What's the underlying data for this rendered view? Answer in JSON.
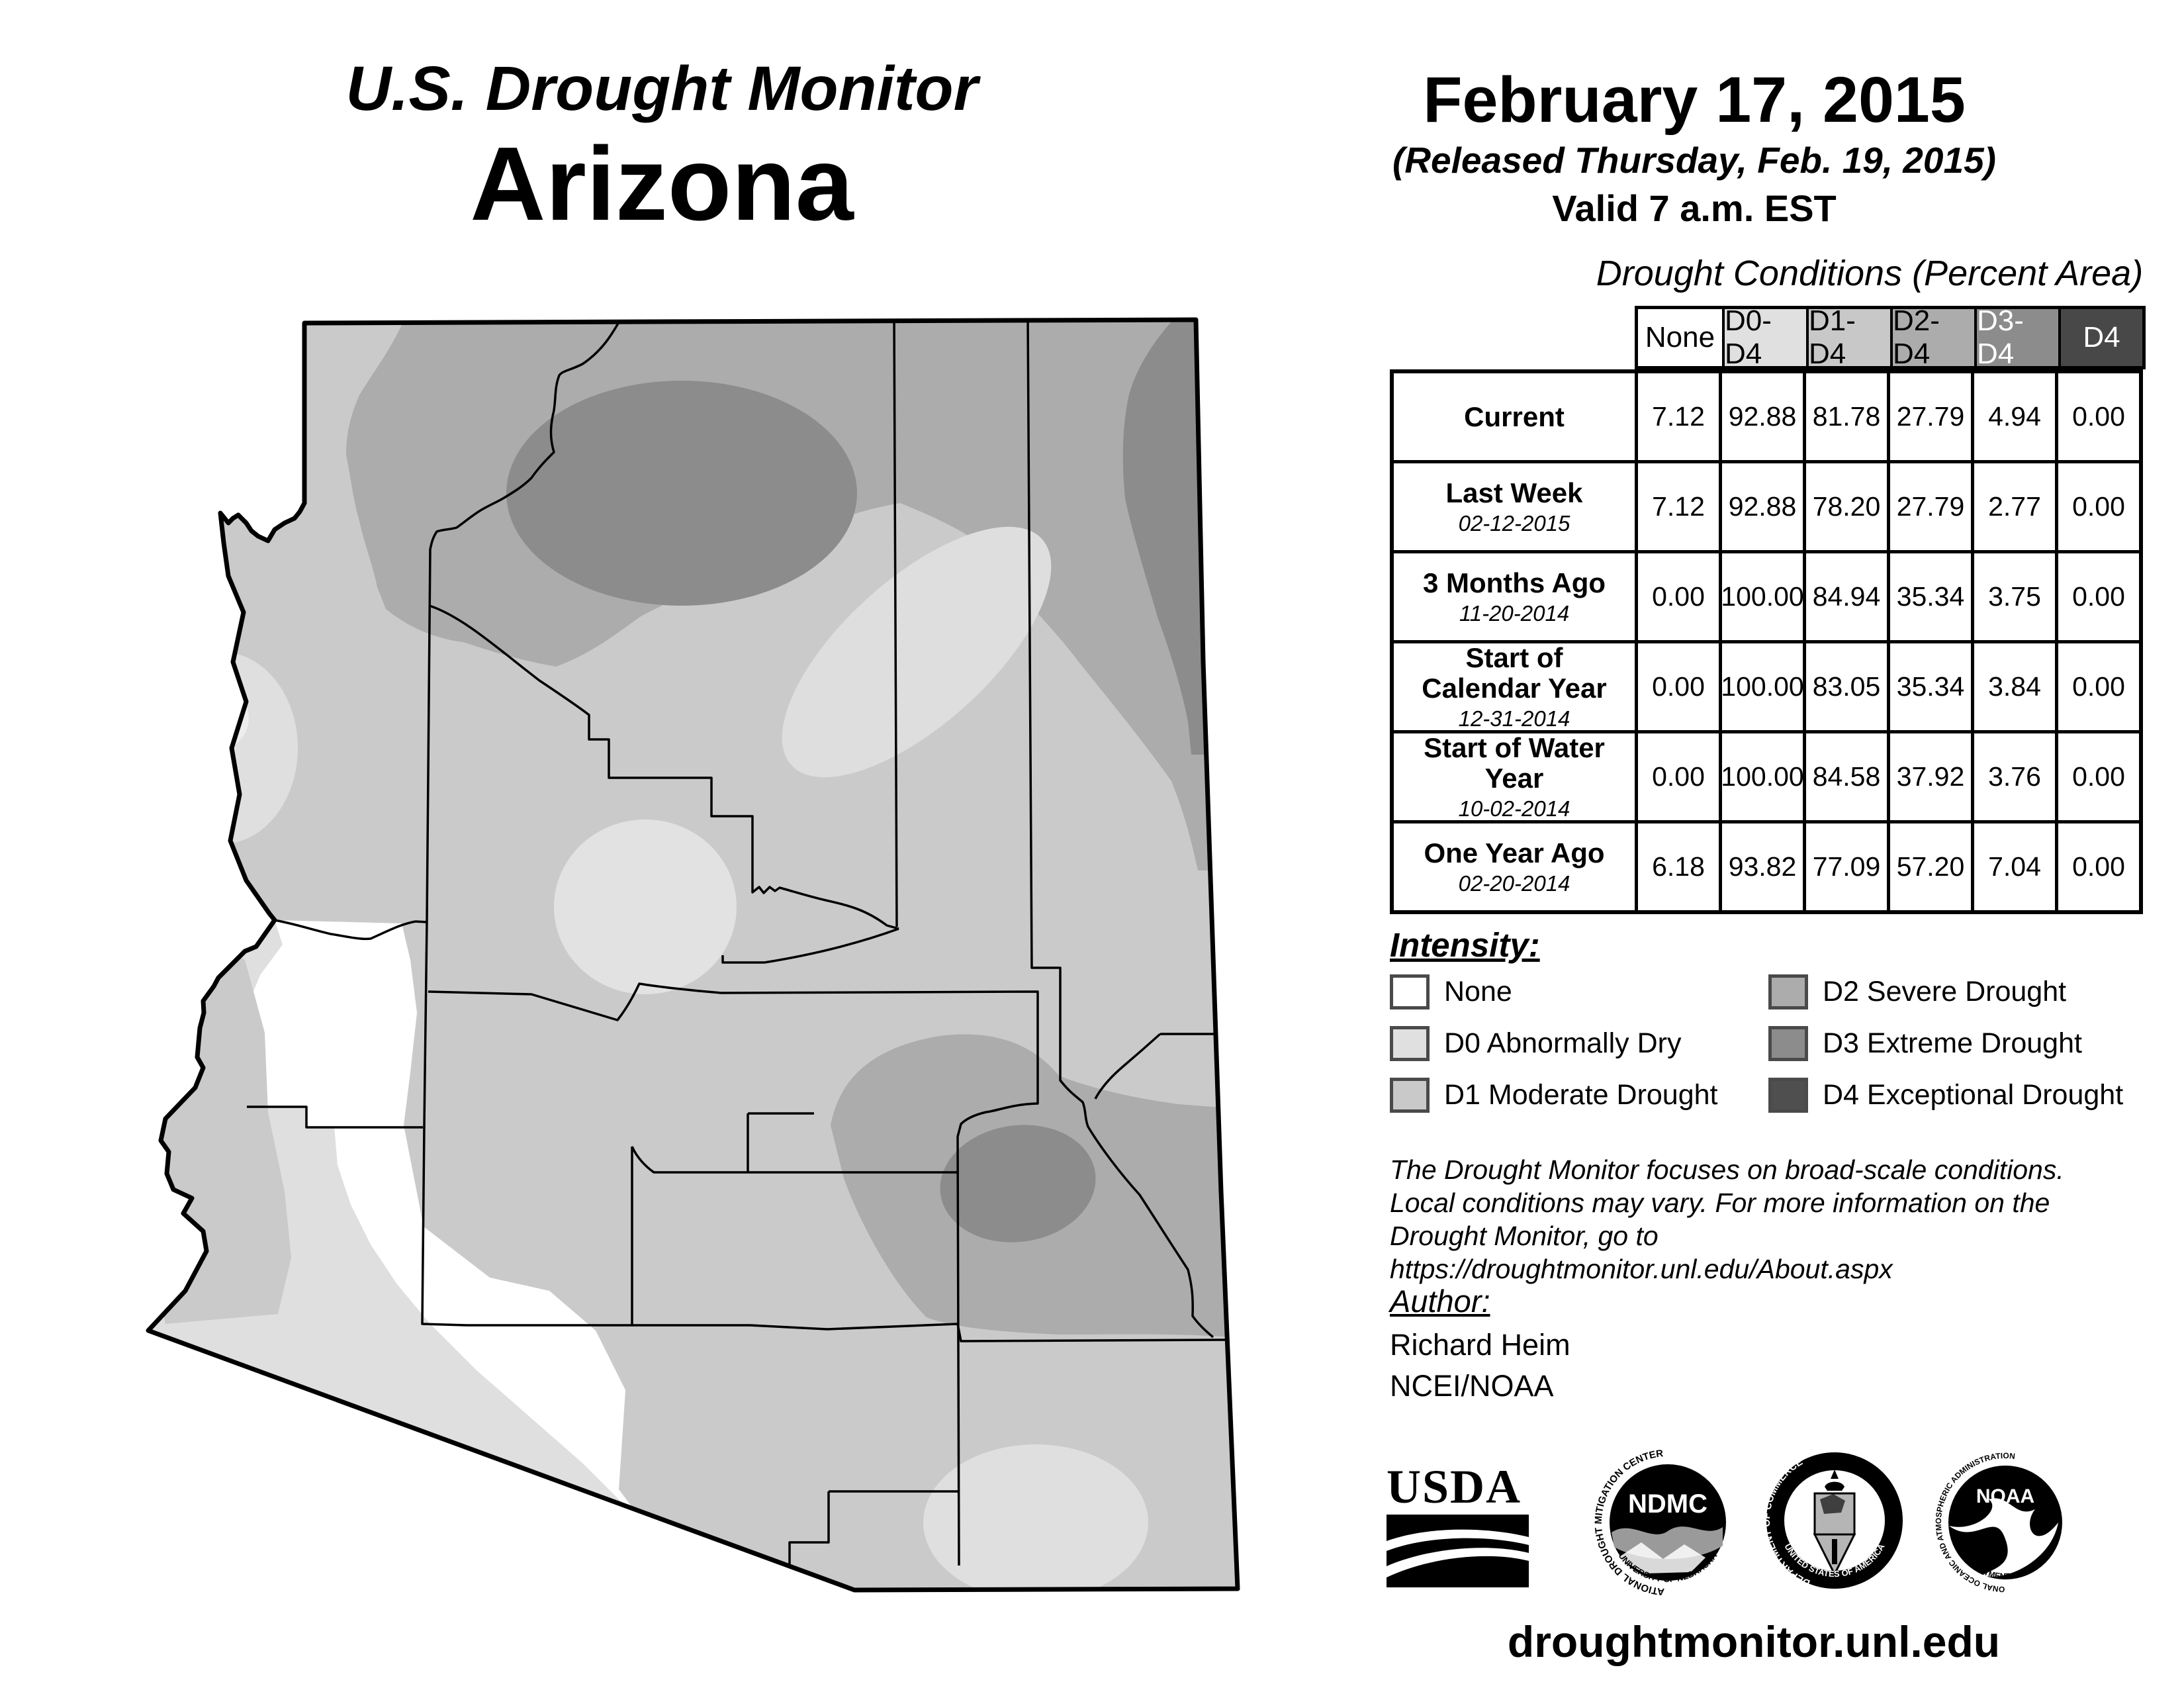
{
  "title": {
    "line1": "U.S. Drought Monitor",
    "line2": "Arizona"
  },
  "date_block": {
    "date": "February 17, 2015",
    "released": "(Released Thursday, Feb. 19, 2015)",
    "valid": "Valid 7 a.m. EST"
  },
  "table": {
    "title": "Drought Conditions (Percent Area)",
    "columns": [
      "None",
      "D0-D4",
      "D1-D4",
      "D2-D4",
      "D3-D4",
      "D4"
    ],
    "rows": [
      {
        "label": "Current",
        "date": "",
        "values": [
          "7.12",
          "92.88",
          "81.78",
          "27.79",
          "4.94",
          "0.00"
        ]
      },
      {
        "label": "Last Week",
        "date": "02-12-2015",
        "values": [
          "7.12",
          "92.88",
          "78.20",
          "27.79",
          "2.77",
          "0.00"
        ]
      },
      {
        "label": "3 Months Ago",
        "date": "11-20-2014",
        "values": [
          "0.00",
          "100.00",
          "84.94",
          "35.34",
          "3.75",
          "0.00"
        ]
      },
      {
        "label": "Start of Calendar Year",
        "date": "12-31-2014",
        "values": [
          "0.00",
          "100.00",
          "83.05",
          "35.34",
          "3.84",
          "0.00"
        ]
      },
      {
        "label": "Start of Water Year",
        "date": "10-02-2014",
        "values": [
          "0.00",
          "100.00",
          "84.58",
          "37.92",
          "3.76",
          "0.00"
        ]
      },
      {
        "label": "One Year Ago",
        "date": "02-20-2014",
        "values": [
          "6.18",
          "93.82",
          "77.09",
          "57.20",
          "7.04",
          "0.00"
        ]
      }
    ]
  },
  "legend": {
    "heading": "Intensity:",
    "items": [
      {
        "label": "None",
        "color": "#ffffff"
      },
      {
        "label": "D0 Abnormally Dry",
        "color": "#e0e0e0"
      },
      {
        "label": "D1 Moderate Drought",
        "color": "#c9c9c9"
      },
      {
        "label": "D2 Severe Drought",
        "color": "#acacac"
      },
      {
        "label": "D3 Extreme Drought",
        "color": "#8c8c8c"
      },
      {
        "label": "D4 Exceptional Drought",
        "color": "#4f4f4f"
      }
    ]
  },
  "disclaimer": {
    "line1": "The Drought Monitor focuses on broad-scale conditions.",
    "line2": "Local conditions may vary. For more information on the",
    "line3": "Drought Monitor, go to https://droughtmonitor.unl.edu/About.aspx"
  },
  "author": {
    "heading": "Author:",
    "name": "Richard Heim",
    "org": "NCEI/NOAA"
  },
  "footer": {
    "url": "droughtmonitor.unl.edu"
  },
  "logos": {
    "usda": {
      "text": "USDA"
    },
    "ndmc": {
      "text": "NDMC",
      "ring_top": "NATIONAL DROUGHT MITIGATION CENTER",
      "ring_bottom": "UNIVERSITY OF NEBRASKA"
    },
    "doc": {
      "ring_top": "DEPARTMENT OF COMMERCE",
      "ring_bottom": "UNITED STATES OF AMERICA"
    },
    "noaa": {
      "text": "NOAA",
      "ring_top": "NATIONAL OCEANIC AND ATMOSPHERIC ADMINISTRATION",
      "ring_bottom": "U.S. DEPARTMENT OF COMMERCE"
    }
  },
  "map": {
    "state": "Arizona",
    "colors": {
      "none": "#ffffff",
      "d0": "#e0e0e0",
      "d1": "#cacaca",
      "d2": "#acacac",
      "d3": "#8c8c8c",
      "d4": "#4f4f4f"
    }
  }
}
